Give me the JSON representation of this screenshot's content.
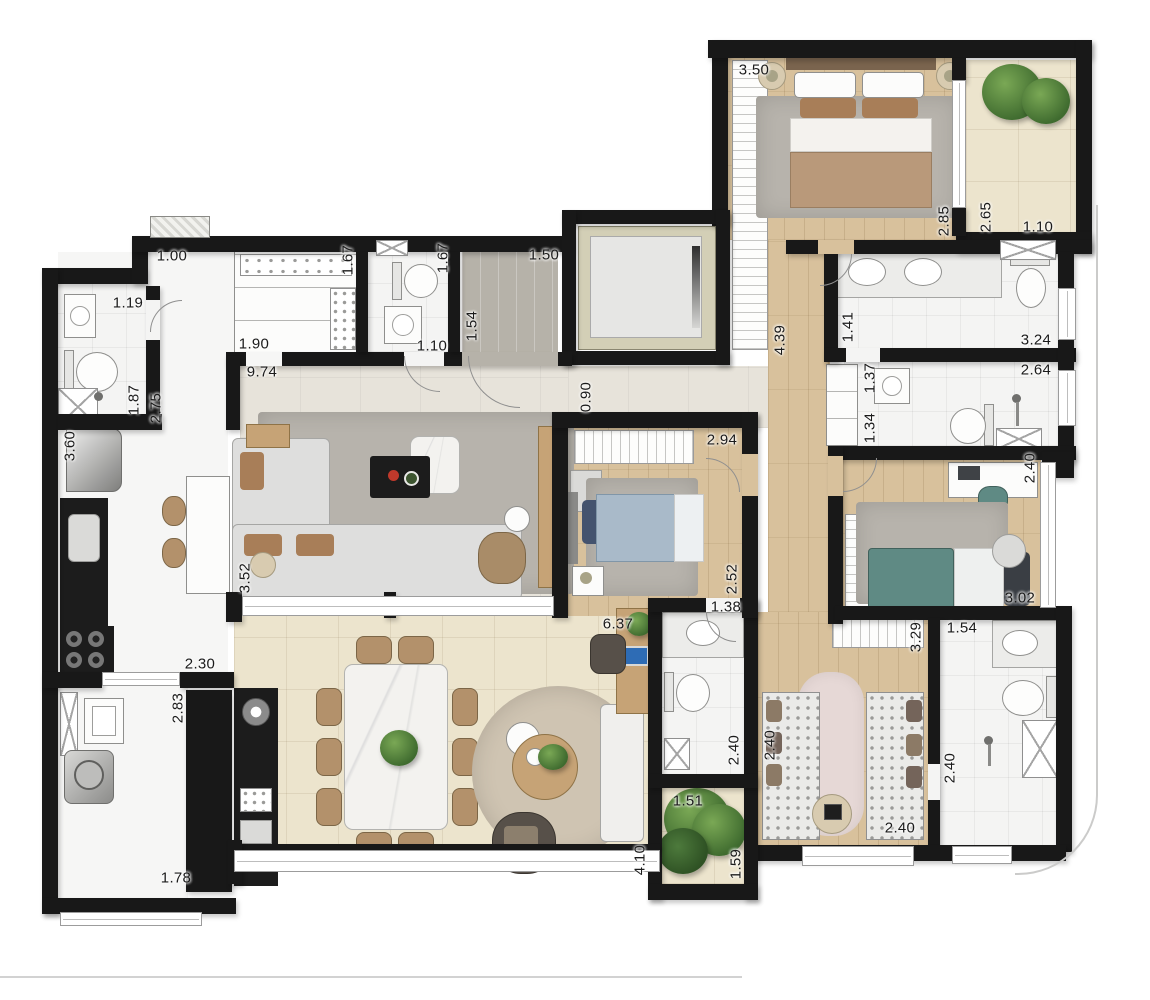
{
  "plan": {
    "kind": "residential-apartment-floor-plan",
    "units": "meters"
  },
  "colors": {
    "wall": "#181818",
    "wood": "#d8c19c",
    "tilecream": "#ece4cd",
    "tilelight": "#e7e3da",
    "rug": "#b7b3ac",
    "pink": "#e6d8d6",
    "counter": "#1c1c1c",
    "green1": "#3f6b2f",
    "green2": "#7aa855",
    "chairbrown": "#b3916b",
    "pillowbrown": "#a87e58",
    "bedteal": "#5f8a84",
    "bedblue": "#a9bac9",
    "bedbrown": "#b9997a"
  },
  "dims": {
    "corridor_w": "1.00",
    "wc_w": "1.19",
    "wc_h": "1.87",
    "corridor_h": "2.75",
    "kitchen_h": "3.60",
    "kitchen_w": "2.30",
    "laundry_h": "2.83",
    "laundry_w": "1.78",
    "pantry_w": "1.90",
    "pantry_h": "1.67",
    "lavabo_h": "1.67",
    "lavabo_w": "1.10",
    "entry_h": "1.54",
    "entry_w": "1.50",
    "hall_l": "9.74",
    "hall_w": "0.90",
    "living_h": "3.52",
    "master_w": "3.50",
    "master_h": "2.85",
    "balcony_h": "2.65",
    "balcony_w": "1.10",
    "mcloset_l": "4.39",
    "mbath_h": "1.41",
    "mbath_w": "3.24",
    "bath2_w": "2.64",
    "bath2_h1": "1.37",
    "bath2_h2": "1.34",
    "bed3_h": "2.40",
    "bed3_w": "3.02",
    "bed2_w": "2.94",
    "bed2_h": "2.52",
    "bath3_w": "1.38",
    "bath3_h": "2.40",
    "bath4_w": "1.54",
    "bath4_h": "2.40",
    "closet_shelf": "3.29",
    "closet_h": "2.40",
    "closet_w": "2.40",
    "terrace_w": "6.37",
    "terrace_h": "4.10",
    "garden_w": "1.51",
    "garden_h": "1.59"
  }
}
